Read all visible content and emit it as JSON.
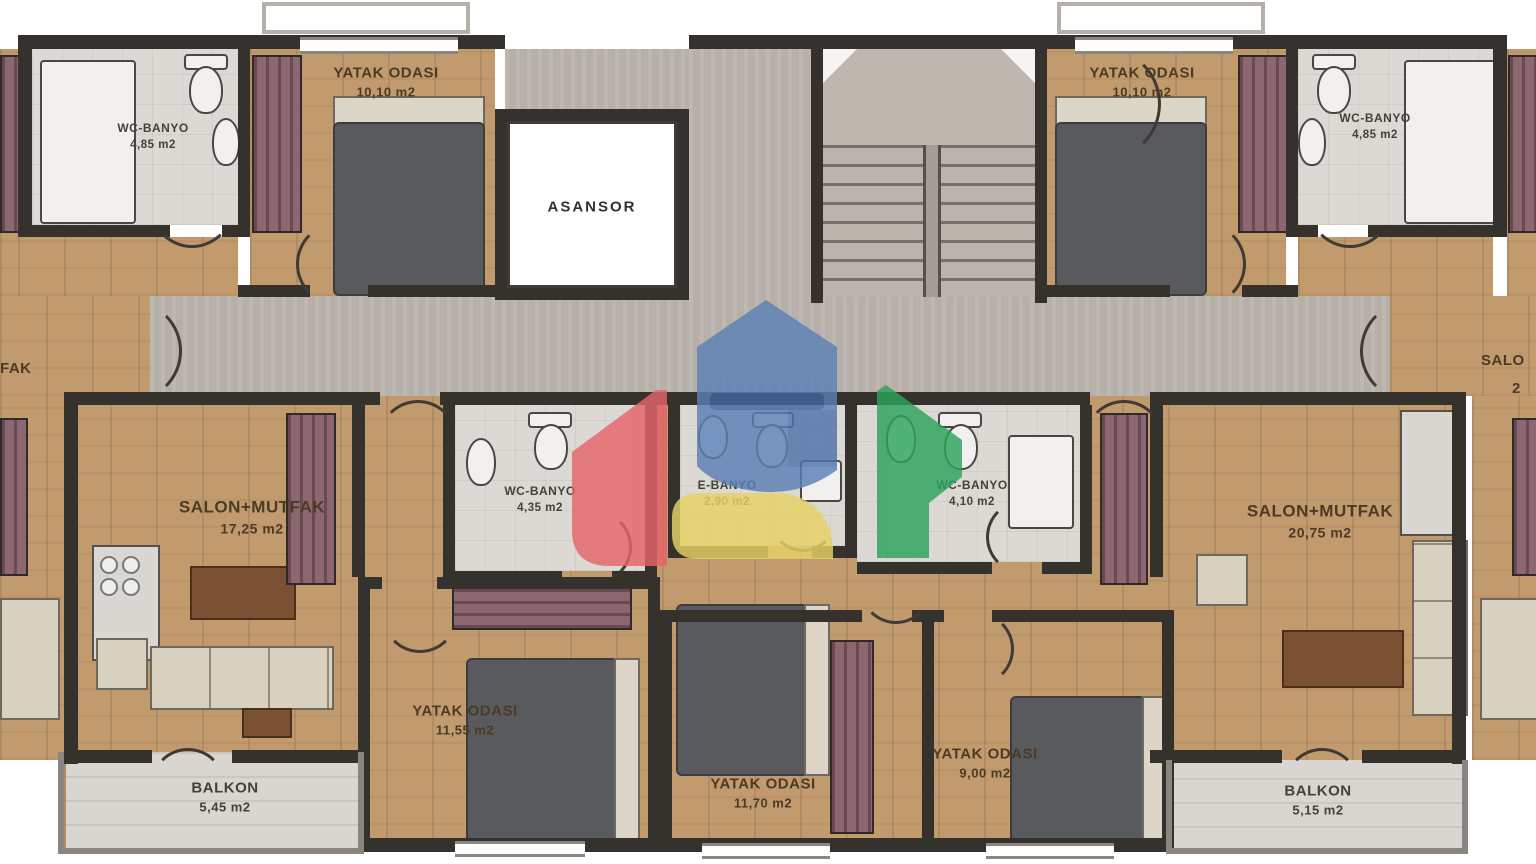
{
  "rooms": {
    "wc_banyo_top_left": {
      "name": "WC-BANYO",
      "area": "4,85 m2"
    },
    "bedroom_top_left": {
      "name": "YATAK ODASI",
      "area": "10,10 m2"
    },
    "elevator": {
      "name": "ASANSOR"
    },
    "bedroom_top_right": {
      "name": "YATAK ODASI",
      "area": "10,10 m2"
    },
    "wc_banyo_top_right": {
      "name": "WC-BANYO",
      "area": "4,85 m2"
    },
    "living_left": {
      "name": "SALON+MUTFAK",
      "area": "17,25 m2"
    },
    "wc_banyo_mid_left": {
      "name": "WC-BANYO",
      "area": "4,35 m2"
    },
    "ensuite_bath": {
      "name": "E-BANYO",
      "area": "2,90 m2"
    },
    "wc_banyo_mid_right": {
      "name": "WC-BANYO",
      "area": "4,10 m2"
    },
    "living_right": {
      "name": "SALON+MUTFAK",
      "area": "20,75 m2"
    },
    "bedroom_bottom_left": {
      "name": "YATAK ODASI",
      "area": "11,55 m2"
    },
    "bedroom_bottom_center": {
      "name": "YATAK ODASI",
      "area": "11,70 m2"
    },
    "bedroom_bottom_right": {
      "name": "YATAK ODASI",
      "area": "9,00 m2"
    },
    "balcony_left": {
      "name": "BALKON",
      "area": "5,45 m2"
    },
    "balcony_right": {
      "name": "BALKON",
      "area": "5,15 m2"
    },
    "edge_left_fragment": {
      "name": "FAK"
    },
    "edge_right_fragment": {
      "name": "SALO",
      "area": "2"
    }
  },
  "watermark": {
    "colors": {
      "blue": "#5b80b6",
      "blue_dark": "#41659e",
      "red": "#e5646b",
      "green": "#2ba35b",
      "yellow": "#e8d266"
    }
  }
}
